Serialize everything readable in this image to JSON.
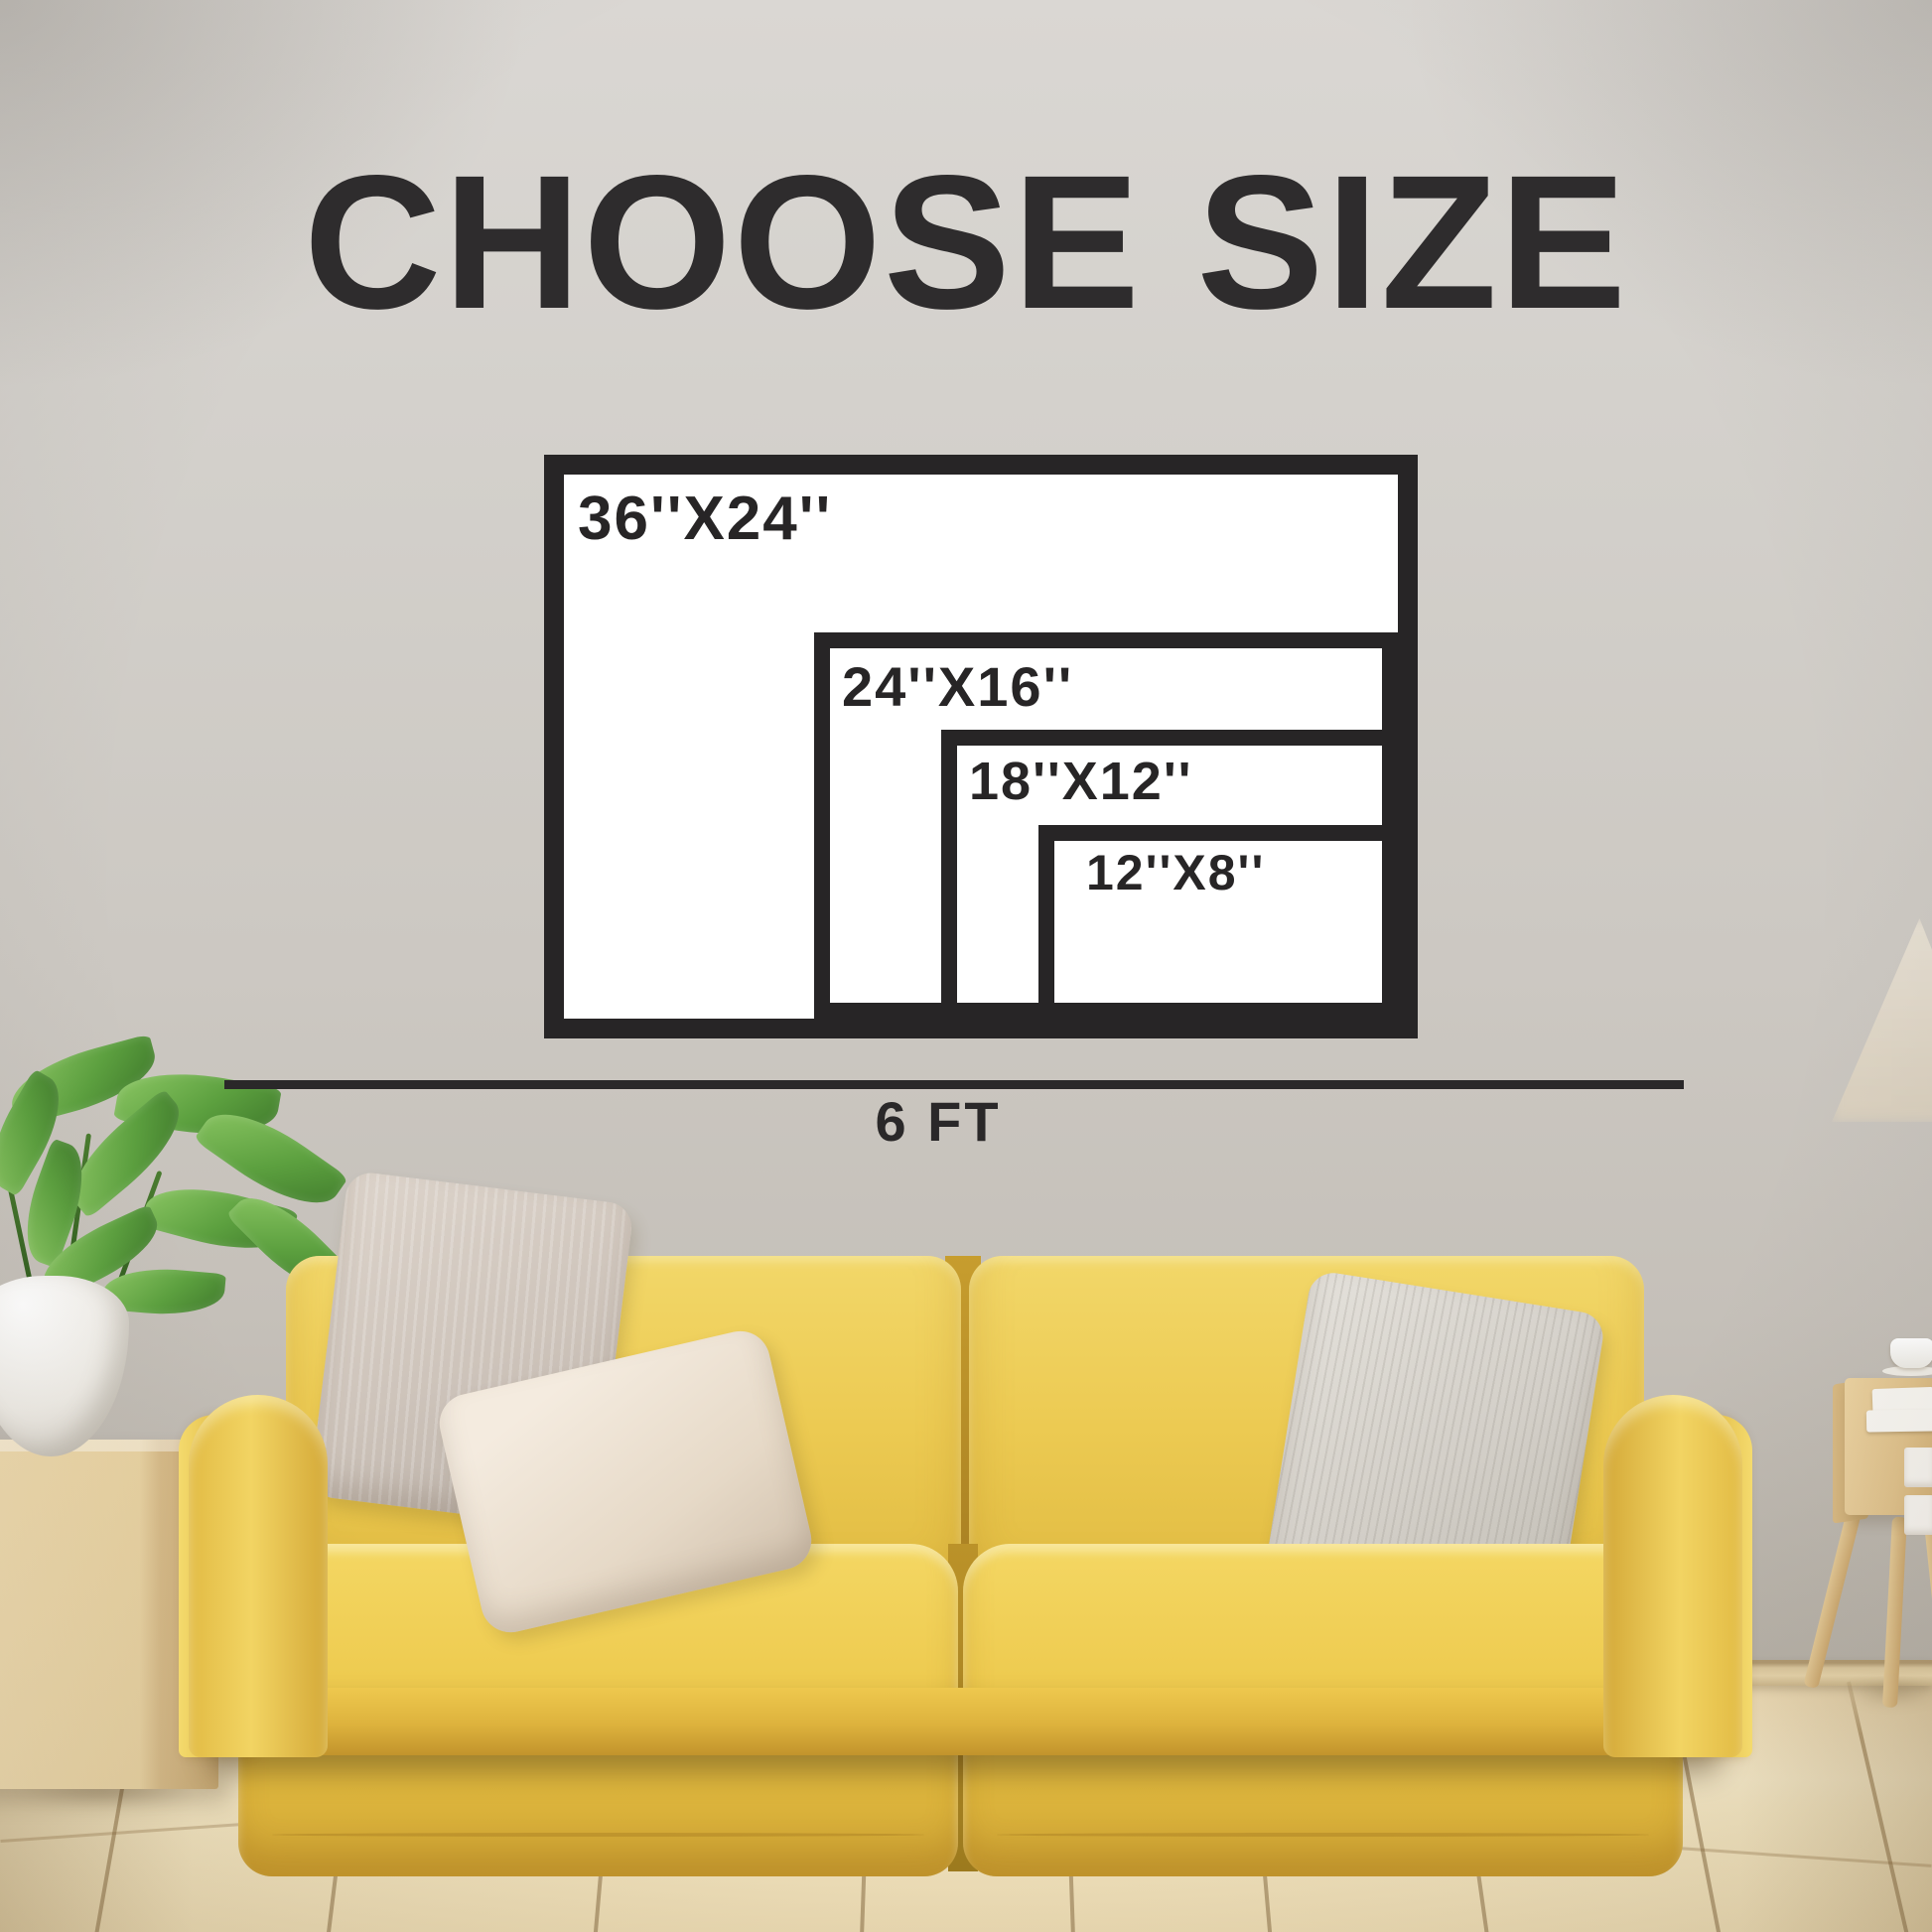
{
  "title": "CHOOSE SIZE",
  "size_chart": {
    "options": [
      {
        "label": "36''X24''",
        "width_in": 36,
        "height_in": 24
      },
      {
        "label": "24''X16''",
        "width_in": 24,
        "height_in": 16
      },
      {
        "label": "18''X12''",
        "width_in": 18,
        "height_in": 12
      },
      {
        "label": "12''X8''",
        "width_in": 12,
        "height_in": 8
      }
    ],
    "scale_label": "6 FT",
    "scale_feet": 6
  },
  "colors": {
    "chart_text": "#2e2c2d",
    "chart_frame": "#272526",
    "chart_fill": "#ffffff",
    "wall_gray": "#cfccc6",
    "sofa_yellow": "#eccb52",
    "floor_wood": "#f2e4c0",
    "pillow_beige": "#d5ccc3",
    "pillow_cream": "#eee3d3",
    "pillow_gray": "#d9d6cf",
    "plant_green": "#5ca03f",
    "wood_light": "#e6cf9e"
  },
  "scene": {
    "objects": [
      "potted-plant",
      "wood-pedestal",
      "yellow-velvet-sofa",
      "throw-pillows",
      "wood-plank-floor",
      "side-table",
      "stacked-books",
      "coffee-cup",
      "floor-lamp-shade"
    ]
  }
}
